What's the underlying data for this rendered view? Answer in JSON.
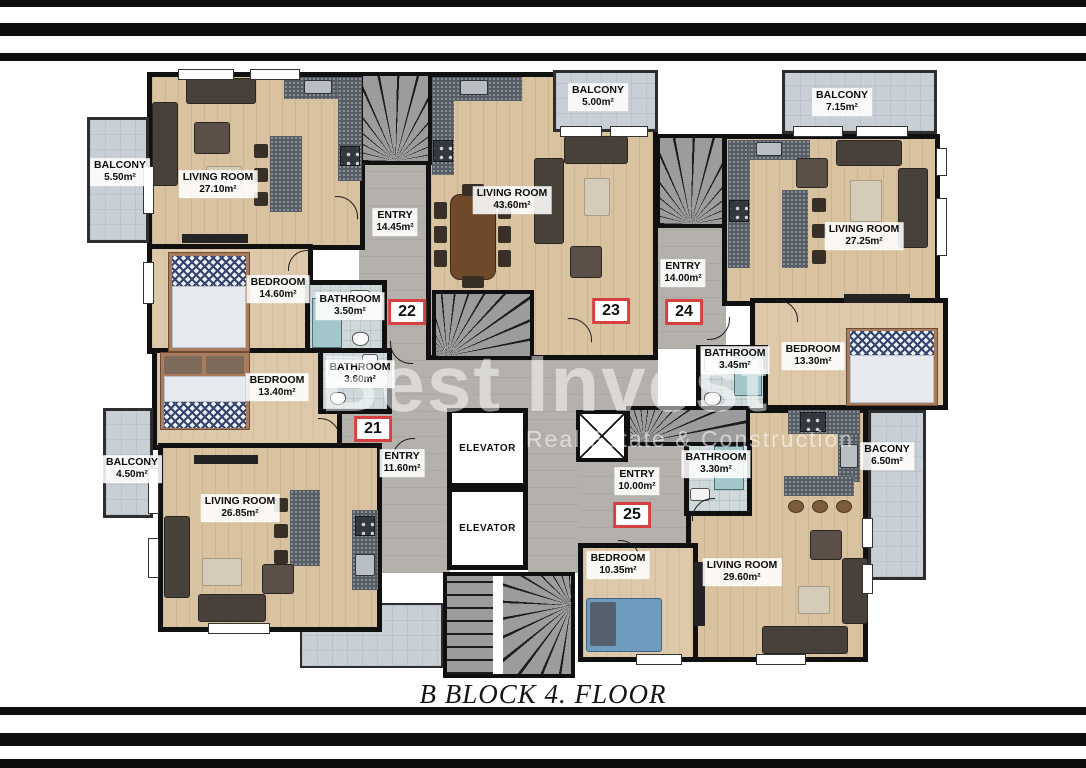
{
  "title": "B BLOCK 4. FLOOR",
  "watermark": {
    "brand": "Best Invest",
    "tagline": "Real Estate & Construction"
  },
  "core": {
    "elevator_label": "ELEVATOR"
  },
  "apartments": {
    "apt21": {
      "badge": "21",
      "bedroom": {
        "name": "BEDROOM",
        "area": "13.40m²"
      },
      "bathroom": {
        "name": "BATHROOM",
        "area": "3.60m²"
      },
      "entry": {
        "name": "ENTRY",
        "area": "11.60m²"
      },
      "living": {
        "name": "LIVING ROOM",
        "area": "26.85m²"
      },
      "balcony": {
        "name": "BALCONY",
        "area": "4.50m²"
      }
    },
    "apt22": {
      "badge": "22",
      "living": {
        "name": "LIVING ROOM",
        "area": "27.10m²"
      },
      "bedroom": {
        "name": "BEDROOM",
        "area": "14.60m²"
      },
      "bathroom": {
        "name": "BATHROOM",
        "area": "3.50m²"
      },
      "entry": {
        "name": "ENTRY",
        "area": "14.45m²"
      },
      "balcony": {
        "name": "BALCONY",
        "area": "5.50m²"
      }
    },
    "apt23": {
      "badge": "23",
      "living": {
        "name": "LIVING ROOM",
        "area": "43.60m²"
      },
      "balcony": {
        "name": "BALCONY",
        "area": "5.00m²"
      }
    },
    "apt24": {
      "badge": "24",
      "living": {
        "name": "LIVING ROOM",
        "area": "27.25m²"
      },
      "entry": {
        "name": "ENTRY",
        "area": "14.00m²"
      },
      "bathroom": {
        "name": "BATHROOM",
        "area": "3.45m²"
      },
      "bedroom": {
        "name": "BEDROOM",
        "area": "13.30m²"
      },
      "balcony": {
        "name": "BALCONY",
        "area": "7.15m²"
      }
    },
    "apt25": {
      "badge": "25",
      "entry": {
        "name": "ENTRY",
        "area": "10.00m²"
      },
      "bathroom": {
        "name": "BATHROOM",
        "area": "3.30m²"
      },
      "bedroom": {
        "name": "BEDROOM",
        "area": "10.35m²"
      },
      "living": {
        "name": "LIVING ROOM",
        "area": "29.60m²"
      },
      "balcony": {
        "name": "BACONY",
        "area": "6.50m²"
      }
    }
  },
  "colors": {
    "accent_red": "#d64040",
    "wall": "#101010",
    "wood_floor": "#d8c2a0",
    "corridor_floor": "#b4b1ac",
    "tile_floor": "#cfd8da",
    "balcony_floor": "#c9cfd6",
    "counter": "#565c63"
  }
}
